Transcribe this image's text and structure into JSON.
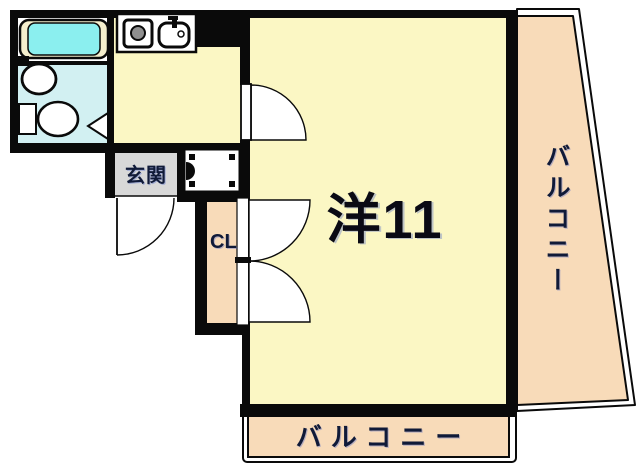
{
  "plan": {
    "labels": {
      "entrance": "玄関",
      "closet": "CL",
      "main_room": "洋11",
      "balcony_right": "バルコニー",
      "balcony_bottom": "バルコニー"
    },
    "icons": {
      "stove": "stove-icon",
      "sink": "sink-icon",
      "bathtub": "bathtub-icon",
      "washbasin": "washbasin-icon",
      "toilet": "toilet-icon",
      "washing_machine_pan": "washing-machine-pan-icon",
      "door_swing": "door-swing-arc",
      "folding_door": "folding-door-triangle"
    },
    "colors": {
      "wall": "#0a0a0a",
      "room_yellow": "#FBF7C4",
      "balcony_peach": "#F8DBB9",
      "bath_floor_cyan": "#D2F0F2",
      "bathtub_cyan": "#8BEFEF",
      "bathtub_rim_cream": "#F5EFCD",
      "entrance_gray": "#D8D8D8",
      "label_navy": "#101A38",
      "burner_gray": "#8f8f8f",
      "background": "#ffffff"
    }
  }
}
